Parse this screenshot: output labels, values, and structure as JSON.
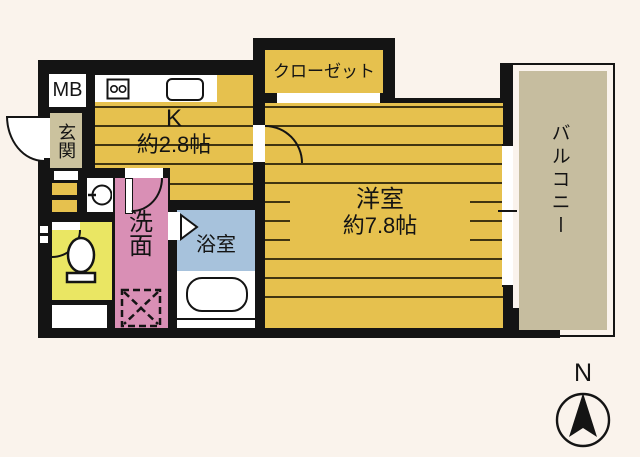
{
  "floorplan": {
    "background": "#FAF3EC",
    "wall_color": "#141414",
    "rooms": {
      "meter_box": {
        "label": "MB",
        "color": "#FFFFFF"
      },
      "entrance": {
        "label": "玄関",
        "color": "#CBC29E"
      },
      "kitchen": {
        "label": "K",
        "size": "約2.8帖",
        "color": "#E6C14E"
      },
      "closet": {
        "label": "クローゼット",
        "color": "#E6C14E"
      },
      "western_room": {
        "label": "洋室",
        "size": "約7.8帖",
        "color": "#E6C14E"
      },
      "washroom": {
        "label": "洗面",
        "color": "#D98FB5"
      },
      "bathroom": {
        "label": "浴室",
        "color": "#A7C2DC"
      },
      "toilet": {
        "color": "#EAE663"
      },
      "balcony": {
        "label": "バルコニー",
        "color": "#C6BD9F"
      },
      "hallway": {
        "color": "#E6C14E"
      }
    },
    "compass": {
      "label": "N"
    },
    "icons": [
      "stove-icon",
      "kitchen-sink-icon",
      "wash-basin-icon",
      "washing-machine-icon",
      "toilet-icon",
      "bathtub-icon",
      "bath-door-icon",
      "folding-door-icon",
      "door-arc-icon",
      "compass-needle-icon",
      "window-icon"
    ]
  }
}
